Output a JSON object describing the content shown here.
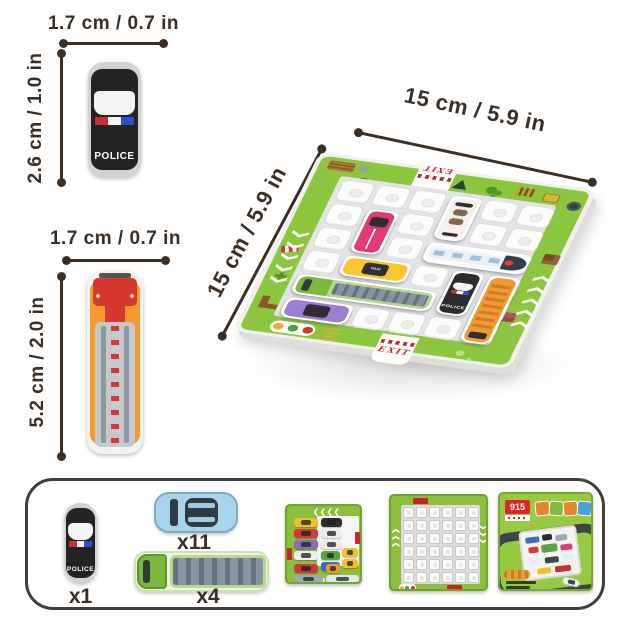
{
  "palette": {
    "ink": "#3b2e24",
    "board_green": "#8cc63e",
    "board_green_dark": "#6aa42c",
    "exit_red": "#c8232c"
  },
  "measurements": {
    "police_width": "1.7 cm / 0.7 in",
    "police_height": "2.6 cm / 1.0 in",
    "firetruck_width": "1.7 cm / 0.7 in",
    "firetruck_height": "5.2 cm / 2.0 in",
    "board_width": "15 cm / 5.9 in",
    "board_depth": "15 cm / 5.9 in"
  },
  "pieces": {
    "police_label": "POLICE"
  },
  "board": {
    "exit_top": "EXIT",
    "exit_front": "EXIT",
    "grid": {
      "rows": 6,
      "cols": 6
    },
    "vehicles": [
      {
        "id": "pink-car",
        "type": "car",
        "color": "#e23a72",
        "col": 1,
        "row": 1,
        "len": 2,
        "dir": "v"
      },
      {
        "id": "taxi",
        "type": "car",
        "color": "#f6c72f",
        "col": 1,
        "row": 3,
        "len": 2,
        "dir": "h",
        "label": "TAXI"
      },
      {
        "id": "white-convertible",
        "type": "conv",
        "color": "#f2f1ee",
        "col": 3,
        "row": 0,
        "len": 2,
        "dir": "v"
      },
      {
        "id": "train",
        "type": "train",
        "color": "#fafafa",
        "col": 3,
        "row": 2,
        "len": 3,
        "dir": "h"
      },
      {
        "id": "police-car",
        "type": "police",
        "color": "#2c2c2e",
        "col": 4,
        "row": 3,
        "len": 2,
        "dir": "v",
        "label": "POLICE"
      },
      {
        "id": "school-bus",
        "type": "bus",
        "color": "#f09a34",
        "col": 5,
        "row": 3,
        "len": 3,
        "dir": "v"
      },
      {
        "id": "cargo-truck",
        "type": "truck",
        "color": "#b7d78c",
        "col": 0,
        "row": 4,
        "len": 4,
        "dir": "h"
      },
      {
        "id": "purple-car",
        "type": "car",
        "color": "#9b7fd1",
        "col": 0,
        "row": 5,
        "len": 2,
        "dir": "h"
      }
    ]
  },
  "contents": {
    "police_count": "x1",
    "car_count": "x11",
    "truck_count": "x4",
    "police_label": "POLICE",
    "cards": {
      "layout_card": {
        "pieces": [
          {
            "x": 7,
            "y": 12,
            "w": 24,
            "h": 9,
            "c": "#f0c02e"
          },
          {
            "x": 34,
            "y": 12,
            "w": 21,
            "h": 9,
            "c": "#2d2d2f"
          },
          {
            "x": 7,
            "y": 23,
            "w": 24,
            "h": 9,
            "c": "#d43a35"
          },
          {
            "x": 34,
            "y": 23,
            "w": 21,
            "h": 9,
            "c": "#ececea"
          },
          {
            "x": 7,
            "y": 34,
            "w": 24,
            "h": 9,
            "c": "#8a6bc0"
          },
          {
            "x": 34,
            "y": 34,
            "w": 21,
            "h": 9,
            "c": "#ececea"
          },
          {
            "x": 7,
            "y": 45,
            "w": 24,
            "h": 9,
            "c": "#ececea"
          },
          {
            "x": 34,
            "y": 45,
            "w": 19,
            "h": 9,
            "c": "#5aa342"
          },
          {
            "x": 55,
            "y": 42,
            "w": 16,
            "h": 9,
            "c": "#f0c02e"
          },
          {
            "x": 34,
            "y": 56,
            "w": 19,
            "h": 9,
            "c": "#3a6fb5"
          },
          {
            "x": 55,
            "y": 53,
            "w": 16,
            "h": 9,
            "c": "#f0c02e"
          },
          {
            "x": 7,
            "y": 58,
            "w": 24,
            "h": 9,
            "c": "#cf3b33"
          },
          {
            "x": 7,
            "y": 69,
            "w": 29,
            "h": 8,
            "c": "#9aa7b4"
          },
          {
            "x": 39,
            "y": 69,
            "w": 33,
            "h": 8,
            "c": "#dfe8ee"
          },
          {
            "x": 39,
            "y": 58,
            "w": 14,
            "h": 9,
            "c": "#ec9b33"
          }
        ]
      },
      "grid_card": {
        "rows": 6,
        "cols": 6
      },
      "box_card": {
        "badge": "915"
      }
    }
  }
}
